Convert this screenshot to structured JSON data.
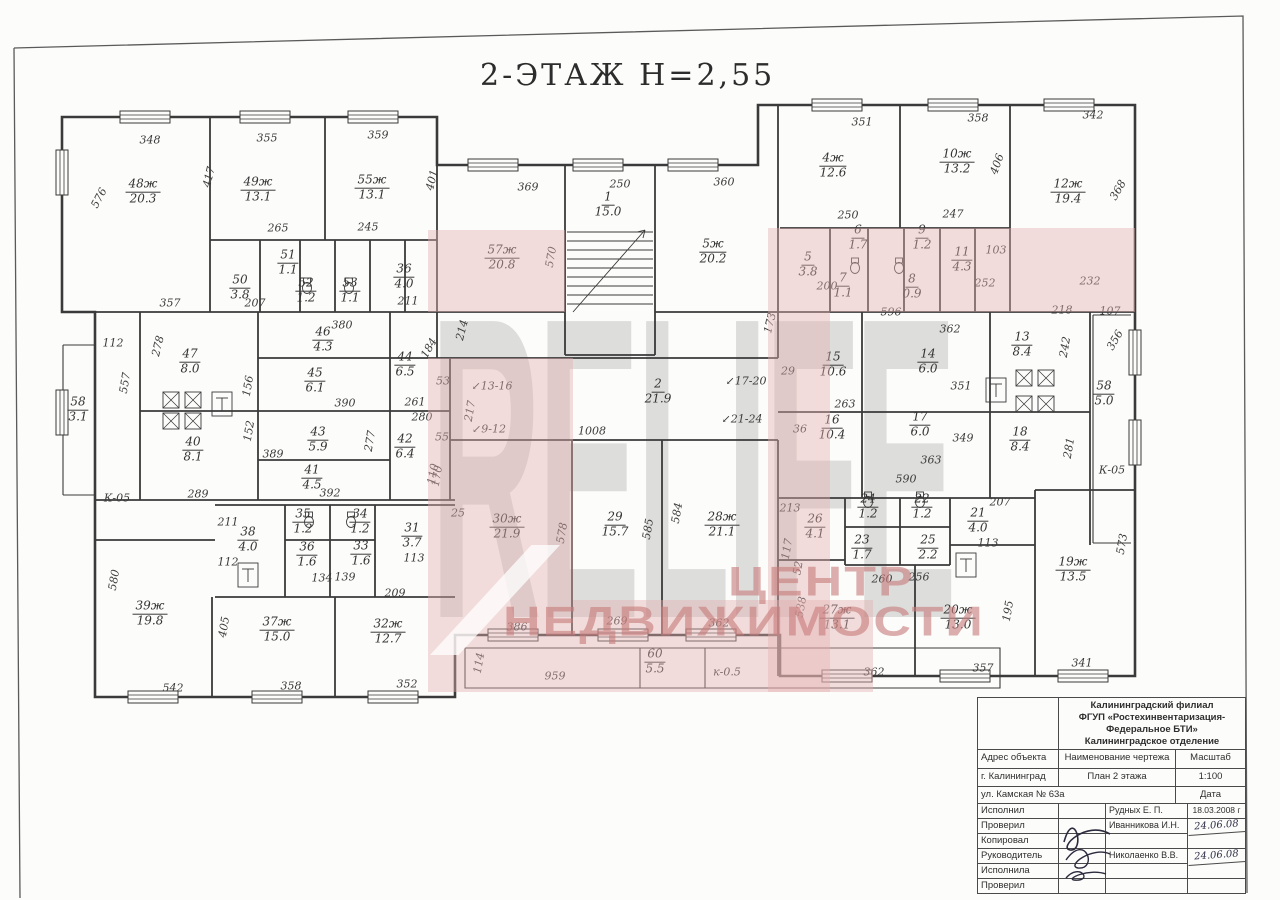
{
  "title": "2-ЭТАЖ  Н=2,55",
  "watermark": {
    "brand": "RELIFE",
    "line1": "ЦЕНТР",
    "line2": "НЕДВИЖИМОСТИ"
  },
  "colors": {
    "paper": "#fcfcfa",
    "ink": "#3a3a3a",
    "watermark_pink": "#e4b0b0",
    "watermark_gray": "#9e9e9e"
  },
  "plan": {
    "rooms": [
      {
        "id": "48ж",
        "area": "20.3",
        "x": 143,
        "y": 192
      },
      {
        "id": "49ж",
        "area": "13.1",
        "x": 258,
        "y": 190
      },
      {
        "id": "55ж",
        "area": "13.1",
        "x": 372,
        "y": 188
      },
      {
        "id": "50",
        "area": "3.8",
        "x": 240,
        "y": 288
      },
      {
        "id": "51",
        "area": "1.1",
        "x": 288,
        "y": 263
      },
      {
        "id": "52",
        "area": "1.2",
        "x": 306,
        "y": 291
      },
      {
        "id": "53",
        "area": "1.1",
        "x": 350,
        "y": 291
      },
      {
        "id": "36",
        "area": "4.0",
        "x": 404,
        "y": 277
      },
      {
        "id": "57ж",
        "area": "20.8",
        "x": 502,
        "y": 258
      },
      {
        "id": "1",
        "area": "15.0",
        "x": 608,
        "y": 205
      },
      {
        "id": "5ж",
        "area": "20.2",
        "x": 713,
        "y": 252
      },
      {
        "id": "4ж",
        "area": "12.6",
        "x": 833,
        "y": 166
      },
      {
        "id": "10ж",
        "area": "13.2",
        "x": 957,
        "y": 162
      },
      {
        "id": "12ж",
        "area": "19.4",
        "x": 1068,
        "y": 192
      },
      {
        "id": "6",
        "area": "1.7",
        "x": 858,
        "y": 238
      },
      {
        "id": "9",
        "area": "1.2",
        "x": 922,
        "y": 238
      },
      {
        "id": "11",
        "area": "4.3",
        "x": 962,
        "y": 260
      },
      {
        "id": "5",
        "area": "3.8",
        "x": 808,
        "y": 265
      },
      {
        "id": "7",
        "area": "1.1",
        "x": 843,
        "y": 286
      },
      {
        "id": "8",
        "area": "0.9",
        "x": 912,
        "y": 287
      },
      {
        "id": "47",
        "area": "8.0",
        "x": 190,
        "y": 362
      },
      {
        "id": "46",
        "area": "4.3",
        "x": 323,
        "y": 340
      },
      {
        "id": "45",
        "area": "6.1",
        "x": 315,
        "y": 381
      },
      {
        "id": "44",
        "area": "6.5",
        "x": 405,
        "y": 365
      },
      {
        "id": "58",
        "area": "3.1",
        "x": 78,
        "y": 410
      },
      {
        "id": "40",
        "area": "8.1",
        "x": 193,
        "y": 450
      },
      {
        "id": "43",
        "area": "5.9",
        "x": 318,
        "y": 440
      },
      {
        "id": "41",
        "area": "4.5",
        "x": 312,
        "y": 478
      },
      {
        "id": "42",
        "area": "6.4",
        "x": 405,
        "y": 447
      },
      {
        "id": "2",
        "area": "21.9",
        "x": 658,
        "y": 392
      },
      {
        "id": "15",
        "area": "10.6",
        "x": 833,
        "y": 365
      },
      {
        "id": "14",
        "area": "6.0",
        "x": 928,
        "y": 362
      },
      {
        "id": "13",
        "area": "8.4",
        "x": 1022,
        "y": 345
      },
      {
        "id": "16",
        "area": "10.4",
        "x": 832,
        "y": 428
      },
      {
        "id": "17",
        "area": "6.0",
        "x": 920,
        "y": 425
      },
      {
        "id": "18",
        "area": "8.4",
        "x": 1020,
        "y": 440
      },
      {
        "id": "58",
        "area": "5.0",
        "x": 1104,
        "y": 394
      },
      {
        "id": "38",
        "area": "4.0",
        "x": 248,
        "y": 540
      },
      {
        "id": "35",
        "area": "1.2",
        "x": 303,
        "y": 522
      },
      {
        "id": "34",
        "area": "1.2",
        "x": 360,
        "y": 522
      },
      {
        "id": "36",
        "area": "1.6",
        "x": 307,
        "y": 555
      },
      {
        "id": "33",
        "area": "1.6",
        "x": 361,
        "y": 554
      },
      {
        "id": "31",
        "area": "3.7",
        "x": 412,
        "y": 536
      },
      {
        "id": "39ж",
        "area": "19.8",
        "x": 150,
        "y": 614
      },
      {
        "id": "37ж",
        "area": "15.0",
        "x": 277,
        "y": 630
      },
      {
        "id": "32ж",
        "area": "12.7",
        "x": 388,
        "y": 632
      },
      {
        "id": "30ж",
        "area": "21.9",
        "x": 507,
        "y": 527
      },
      {
        "id": "29",
        "area": "15.7",
        "x": 615,
        "y": 525
      },
      {
        "id": "28ж",
        "area": "21.1",
        "x": 722,
        "y": 525
      },
      {
        "id": "26",
        "area": "4.1",
        "x": 815,
        "y": 527
      },
      {
        "id": "21",
        "area": "4.0",
        "x": 978,
        "y": 521
      },
      {
        "id": "24",
        "area": "1.2",
        "x": 868,
        "y": 507
      },
      {
        "id": "22",
        "area": "1.2",
        "x": 922,
        "y": 507
      },
      {
        "id": "23",
        "area": "1.7",
        "x": 862,
        "y": 548
      },
      {
        "id": "25",
        "area": "2.2",
        "x": 928,
        "y": 548
      },
      {
        "id": "27ж",
        "area": "13.1",
        "x": 837,
        "y": 618
      },
      {
        "id": "20ж",
        "area": "13.0",
        "x": 958,
        "y": 618
      },
      {
        "id": "19ж",
        "area": "13.5",
        "x": 1073,
        "y": 570
      },
      {
        "id": "60",
        "area": "5.5",
        "x": 655,
        "y": 662
      }
    ],
    "dims": [
      {
        "t": "348",
        "x": 150,
        "y": 140
      },
      {
        "t": "355",
        "x": 267,
        "y": 138
      },
      {
        "t": "359",
        "x": 378,
        "y": 135
      },
      {
        "t": "576",
        "x": 99,
        "y": 198,
        "r": -62
      },
      {
        "t": "417",
        "x": 209,
        "y": 177,
        "r": -76
      },
      {
        "t": "401",
        "x": 432,
        "y": 180,
        "r": -76
      },
      {
        "t": "265",
        "x": 278,
        "y": 228
      },
      {
        "t": "245",
        "x": 368,
        "y": 227
      },
      {
        "t": "357",
        "x": 170,
        "y": 303
      },
      {
        "t": "207",
        "x": 255,
        "y": 303
      },
      {
        "t": "211",
        "x": 408,
        "y": 301
      },
      {
        "t": "369",
        "x": 528,
        "y": 187
      },
      {
        "t": "250",
        "x": 620,
        "y": 184
      },
      {
        "t": "360",
        "x": 724,
        "y": 182
      },
      {
        "t": "570",
        "x": 551,
        "y": 257,
        "r": -80
      },
      {
        "t": "214",
        "x": 462,
        "y": 330,
        "r": -76
      },
      {
        "t": "173",
        "x": 770,
        "y": 323,
        "r": -76
      },
      {
        "t": "351",
        "x": 862,
        "y": 122
      },
      {
        "t": "358",
        "x": 978,
        "y": 118
      },
      {
        "t": "342",
        "x": 1093,
        "y": 115
      },
      {
        "t": "406",
        "x": 997,
        "y": 164,
        "r": -70
      },
      {
        "t": "368",
        "x": 1118,
        "y": 190,
        "r": -60
      },
      {
        "t": "250",
        "x": 848,
        "y": 215
      },
      {
        "t": "247",
        "x": 953,
        "y": 214
      },
      {
        "t": "200",
        "x": 827,
        "y": 286
      },
      {
        "t": "103",
        "x": 996,
        "y": 250
      },
      {
        "t": "252",
        "x": 985,
        "y": 283
      },
      {
        "t": "232",
        "x": 1090,
        "y": 281
      },
      {
        "t": "596",
        "x": 891,
        "y": 312
      },
      {
        "t": "218",
        "x": 1062,
        "y": 310
      },
      {
        "t": "107",
        "x": 1110,
        "y": 311
      },
      {
        "t": "356",
        "x": 1115,
        "y": 340,
        "r": -60
      },
      {
        "t": "112",
        "x": 113,
        "y": 343
      },
      {
        "t": "278",
        "x": 158,
        "y": 346,
        "r": -76
      },
      {
        "t": "557",
        "x": 125,
        "y": 383,
        "r": -80
      },
      {
        "t": "380",
        "x": 342,
        "y": 325
      },
      {
        "t": "156",
        "x": 248,
        "y": 386,
        "r": -80
      },
      {
        "t": "390",
        "x": 345,
        "y": 403
      },
      {
        "t": "261",
        "x": 415,
        "y": 402
      },
      {
        "t": "280",
        "x": 422,
        "y": 417
      },
      {
        "t": "184",
        "x": 429,
        "y": 348,
        "r": -60
      },
      {
        "t": "389",
        "x": 273,
        "y": 454
      },
      {
        "t": "392",
        "x": 330,
        "y": 493
      },
      {
        "t": "152",
        "x": 249,
        "y": 431,
        "r": -80
      },
      {
        "t": "277",
        "x": 370,
        "y": 441,
        "r": -80
      },
      {
        "t": "110",
        "x": 433,
        "y": 474,
        "r": -80
      },
      {
        "t": "55",
        "x": 442,
        "y": 437
      },
      {
        "t": "53",
        "x": 443,
        "y": 381
      },
      {
        "t": "289",
        "x": 198,
        "y": 494
      },
      {
        "t": "217",
        "x": 470,
        "y": 411,
        "r": -80
      },
      {
        "t": "1008",
        "x": 592,
        "y": 431
      },
      {
        "t": "170",
        "x": 437,
        "y": 476,
        "r": -80
      },
      {
        "t": "29",
        "x": 788,
        "y": 371
      },
      {
        "t": "36",
        "x": 800,
        "y": 429
      },
      {
        "t": "↙13-16",
        "x": 492,
        "y": 386
      },
      {
        "t": "↙9-12",
        "x": 489,
        "y": 429
      },
      {
        "t": "↙17-20",
        "x": 746,
        "y": 381
      },
      {
        "t": "↙21-24",
        "x": 742,
        "y": 419
      },
      {
        "t": "362",
        "x": 950,
        "y": 329
      },
      {
        "t": "351",
        "x": 961,
        "y": 386
      },
      {
        "t": "263",
        "x": 845,
        "y": 404
      },
      {
        "t": "349",
        "x": 963,
        "y": 438
      },
      {
        "t": "363",
        "x": 931,
        "y": 460
      },
      {
        "t": "590",
        "x": 906,
        "y": 479
      },
      {
        "t": "242",
        "x": 1065,
        "y": 347,
        "r": -80
      },
      {
        "t": "281",
        "x": 1069,
        "y": 448,
        "r": -80
      },
      {
        "t": "К-05",
        "x": 117,
        "y": 498
      },
      {
        "t": "К-05",
        "x": 1112,
        "y": 470
      },
      {
        "t": "211",
        "x": 228,
        "y": 522
      },
      {
        "t": "112",
        "x": 228,
        "y": 562
      },
      {
        "t": "134",
        "x": 322,
        "y": 578
      },
      {
        "t": "139",
        "x": 345,
        "y": 577
      },
      {
        "t": "209",
        "x": 395,
        "y": 593
      },
      {
        "t": "113",
        "x": 414,
        "y": 558
      },
      {
        "t": "580",
        "x": 114,
        "y": 580,
        "r": -80
      },
      {
        "t": "405",
        "x": 224,
        "y": 627,
        "r": -80
      },
      {
        "t": "542",
        "x": 173,
        "y": 688
      },
      {
        "t": "358",
        "x": 291,
        "y": 686
      },
      {
        "t": "352",
        "x": 407,
        "y": 684
      },
      {
        "t": "25",
        "x": 458,
        "y": 513
      },
      {
        "t": "578",
        "x": 562,
        "y": 533,
        "r": -80
      },
      {
        "t": "585",
        "x": 648,
        "y": 529,
        "r": -80
      },
      {
        "t": "584",
        "x": 677,
        "y": 513,
        "r": -80
      },
      {
        "t": "386",
        "x": 517,
        "y": 627
      },
      {
        "t": "269",
        "x": 617,
        "y": 621
      },
      {
        "t": "362",
        "x": 719,
        "y": 623
      },
      {
        "t": "213",
        "x": 790,
        "y": 508
      },
      {
        "t": "117",
        "x": 787,
        "y": 549,
        "r": -80
      },
      {
        "t": "52",
        "x": 798,
        "y": 568,
        "r": -80
      },
      {
        "t": "538",
        "x": 801,
        "y": 607,
        "r": -80
      },
      {
        "t": "114",
        "x": 479,
        "y": 663,
        "r": -80
      },
      {
        "t": "959",
        "x": 555,
        "y": 676
      },
      {
        "t": "к-0.5",
        "x": 727,
        "y": 672
      },
      {
        "t": "207",
        "x": 1000,
        "y": 502
      },
      {
        "t": "113",
        "x": 988,
        "y": 543
      },
      {
        "t": "260",
        "x": 882,
        "y": 579
      },
      {
        "t": "256",
        "x": 919,
        "y": 577
      },
      {
        "t": "195",
        "x": 1008,
        "y": 611,
        "r": -80
      },
      {
        "t": "573",
        "x": 1122,
        "y": 544,
        "r": -80
      },
      {
        "t": "362",
        "x": 874,
        "y": 672
      },
      {
        "t": "357",
        "x": 983,
        "y": 668
      },
      {
        "t": "341",
        "x": 1082,
        "y": 663
      }
    ]
  },
  "title_block": {
    "org_lines": [
      "Калининградский филиал",
      "ФГУП «Ростехинвентаризация-",
      "Федеральное БТИ»",
      "Калининградское отделение"
    ],
    "address_header": "Адрес объекта",
    "drawing_header": "Наименование чертежа",
    "scale_header": "Масштаб",
    "city": "г. Калининград",
    "drawing_name": "План 2 этажа",
    "scale": "1:100",
    "street": "ул. Камская № 63а",
    "date_header": "Дата",
    "rows": [
      {
        "role": "Исполнил",
        "name": "Рудных Е. П.",
        "date": "18.03.2008 г",
        "hand": false
      },
      {
        "role": "Проверил",
        "name": "Иванникова И.Н.",
        "date": "24.06.08",
        "hand": true
      },
      {
        "role": "Копировал",
        "name": "",
        "date": "",
        "hand": false
      },
      {
        "role": "Руководитель",
        "name": "Николаенко В.В.",
        "date": "24.06.08",
        "hand": true
      },
      {
        "role": "Исполнила",
        "name": "",
        "date": "",
        "hand": false
      },
      {
        "role": "Проверил",
        "name": "",
        "date": "",
        "hand": false
      }
    ]
  }
}
